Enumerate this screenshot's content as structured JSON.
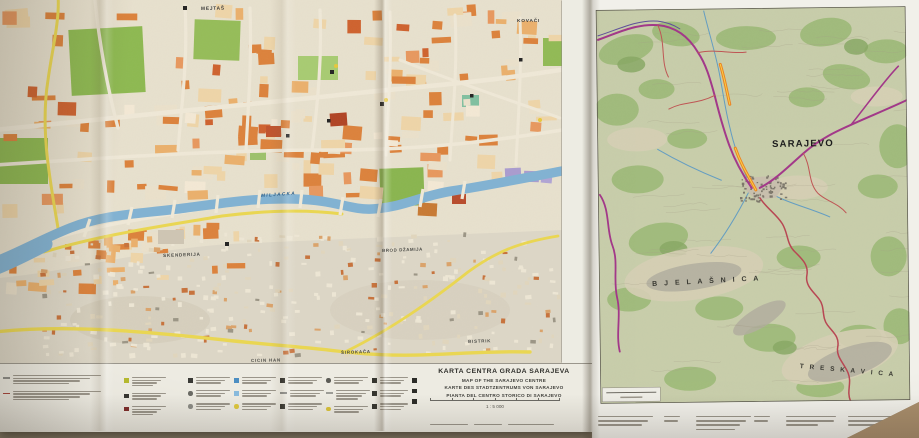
{
  "colors": {
    "table": "#a98e6c",
    "paper_city": "#e9e2cf",
    "paper_margin": "#edebe2",
    "river_blue": "#7fb2d4",
    "park_green": "#8cb94e",
    "block_orange": "#dd8038",
    "road_yellow": "#ecd84e",
    "hill_gray": "#ded8c8",
    "topo_base": "#c9cfab",
    "topo_forest": "#9cba76",
    "road_magenta": "#a23188",
    "road_red": "#b8404e",
    "highway_orange": "#ef7f1c",
    "water_blue": "#5f9cc4"
  },
  "labels": [
    {
      "id": "mejtas",
      "text": "MEJTAŠ",
      "x": 201,
      "y": 8,
      "size": 4.8,
      "color": "#3b3b3b",
      "spacing": 0.8,
      "rotate": -1
    },
    {
      "id": "kovaci",
      "text": "KOVAČI",
      "x": 517,
      "y": 20,
      "size": 4.8,
      "color": "#3b3b3b",
      "spacing": 0.8,
      "rotate": 0
    },
    {
      "id": "miljacka-river",
      "text": "MILJACKA",
      "x": 261,
      "y": 194,
      "size": 4.6,
      "color": "#2f6089",
      "spacing": 1.4,
      "italic": true,
      "rotate": -4
    },
    {
      "id": "skenderija",
      "text": "SKENDERIJA",
      "x": 163,
      "y": 254,
      "size": 4.6,
      "color": "#4a4a46",
      "spacing": 0.8,
      "rotate": -2
    },
    {
      "id": "brod-dzamija",
      "text": "BROD DŽAMIJA",
      "x": 382,
      "y": 249,
      "size": 4.4,
      "color": "#4a4a46",
      "spacing": 0.6,
      "rotate": -2
    },
    {
      "id": "bistrik",
      "text": "BISTRIK",
      "x": 468,
      "y": 340,
      "size": 4.4,
      "color": "#4a4a46",
      "spacing": 0.8,
      "rotate": -2
    },
    {
      "id": "cicin-han",
      "text": "CICIN HAN",
      "x": 251,
      "y": 359,
      "size": 4.4,
      "color": "#4a4a46",
      "spacing": 0.8,
      "rotate": -1
    },
    {
      "id": "sirokaca",
      "text": "ŠIROKAČA",
      "x": 341,
      "y": 351,
      "size": 4.4,
      "color": "#4a4a46",
      "spacing": 0.8,
      "rotate": -2
    },
    {
      "id": "sarajevo",
      "text": "SARAJEVO",
      "x": 772,
      "y": 140,
      "size": 9.5,
      "color": "#1c1c1c",
      "spacing": 1.2,
      "weight": 700,
      "rotate": -1
    },
    {
      "id": "bjelasnica-range",
      "text": "B J E L A Š N I C A",
      "x": 652,
      "y": 281,
      "size": 7,
      "color": "#3a3a33",
      "spacing": 2.5,
      "rotate": -3
    },
    {
      "id": "treskavica-range",
      "text": "T R E S K A V I C A",
      "x": 800,
      "y": 364,
      "size": 6.5,
      "color": "#3a3a33",
      "spacing": 2,
      "rotate": 5
    }
  ],
  "legend": {
    "title_lines": [
      "KARTA CENTRA GRADA SARAJEVA",
      "MAP OF THE SARAJEVO CENTRE",
      "KARTE DES STADTZENTRUMS VON SARAJEVO",
      "PIANTA DEL CENTRO STORICO DI SARAJEVO"
    ],
    "scale_text": "1 : 5 000",
    "columns": [
      {
        "x": 3,
        "y": 11,
        "w": 88,
        "items": [
          {
            "sym": "dash",
            "color": "#8c8c88",
            "lines": 4
          },
          {
            "sym": "dash",
            "color": "#a8433a",
            "lines": 4
          }
        ]
      },
      {
        "x": 124,
        "y": 13,
        "w": 34,
        "items": [
          {
            "sym": "square",
            "color": "#b5b92f",
            "lines": 4
          },
          {
            "sym": "square",
            "color": "#35352f",
            "lines": 3
          },
          {
            "sym": "square",
            "color": "#7e2c2a",
            "lines": 4
          }
        ]
      },
      {
        "x": 188,
        "y": 13,
        "w": 34,
        "items": [
          {
            "sym": "square",
            "color": "#3a3a36",
            "lines": 3
          },
          {
            "sym": "circle",
            "color": "#6a6a64",
            "lines": 3
          },
          {
            "sym": "circle",
            "color": "#8c8c86",
            "lines": 3
          }
        ]
      },
      {
        "x": 234,
        "y": 13,
        "w": 34,
        "items": [
          {
            "sym": "square",
            "color": "#4c8ec2",
            "lines": 3
          },
          {
            "sym": "square",
            "color": "#88badc",
            "lines": 3
          },
          {
            "sym": "circle",
            "color": "#dfc93e",
            "lines": 3
          }
        ]
      },
      {
        "x": 280,
        "y": 13,
        "w": 34,
        "items": [
          {
            "sym": "square",
            "color": "#35352f",
            "lines": 3
          },
          {
            "sym": "dash",
            "color": "#8c8c88",
            "lines": 3
          },
          {
            "sym": "square",
            "color": "#35352f",
            "lines": 3
          }
        ]
      },
      {
        "x": 326,
        "y": 13,
        "w": 34,
        "items": [
          {
            "sym": "circle",
            "color": "#5c5c56",
            "lines": 3
          },
          {
            "sym": "dash",
            "color": "#9c9c96",
            "lines": 4
          },
          {
            "sym": "circle",
            "color": "#d9c23a",
            "lines": 3
          }
        ]
      },
      {
        "x": 372,
        "y": 13,
        "w": 28,
        "items": [
          {
            "sym": "square",
            "color": "#35352f",
            "lines": 3
          },
          {
            "sym": "square",
            "color": "#35352f",
            "lines": 3
          },
          {
            "sym": "square",
            "color": "#35352f",
            "lines": 3
          }
        ]
      },
      {
        "x": 412,
        "y": 13,
        "w": 0,
        "items": [
          {
            "sym": "square",
            "color": "#2c2c28",
            "lines": 0
          },
          {
            "sym": "square",
            "color": "#2c2c28",
            "lines": 0
          },
          {
            "sym": "square",
            "color": "#2c2c28",
            "lines": 0
          }
        ]
      }
    ]
  }
}
